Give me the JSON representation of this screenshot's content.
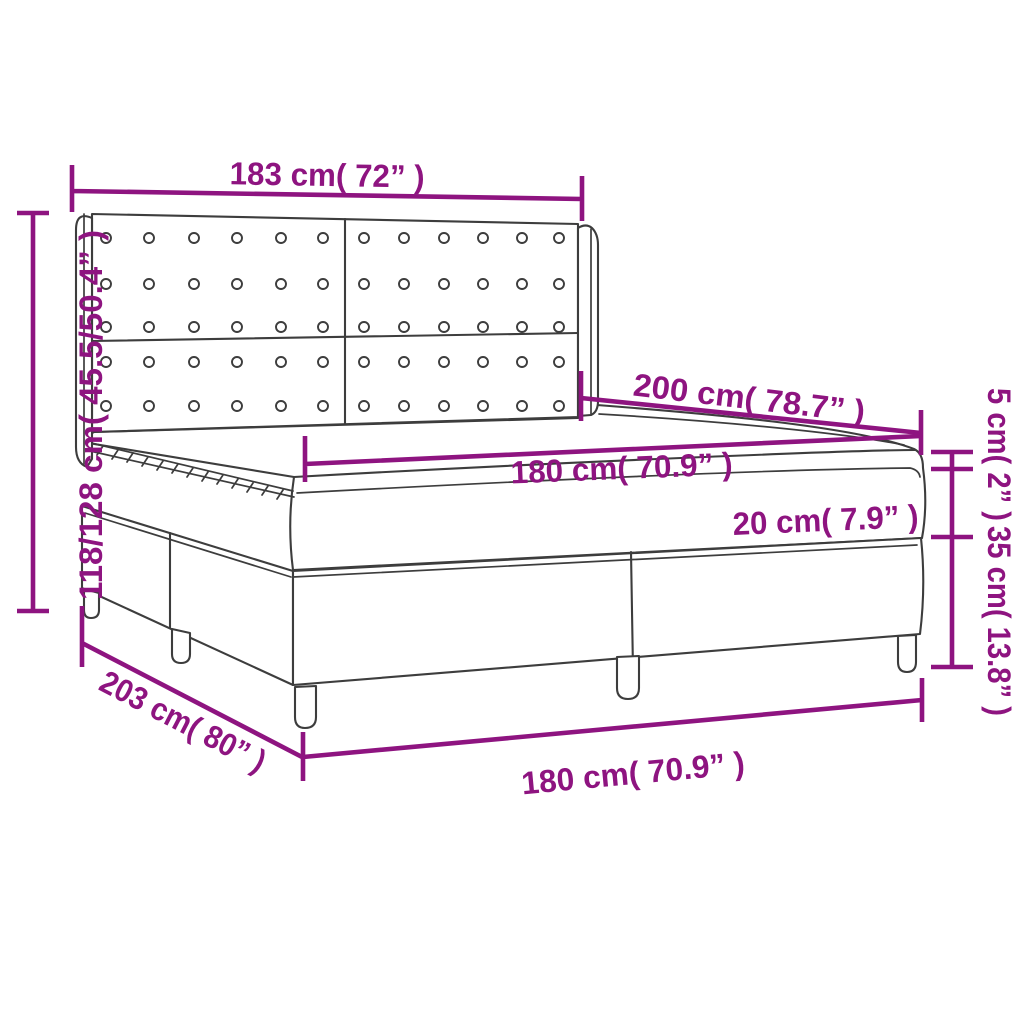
{
  "diagram": {
    "labels": {
      "headboard_width": "183 cm( 72” )",
      "headboard_height": "118/128 cm( 45.5/50.4” )",
      "bed_length": "200 cm( 78.7” )",
      "mattress_width": "180 cm( 70.9” )",
      "mattress_thickness": "20 cm( 7.9” )",
      "topper_thickness": "5 cm( 2” )",
      "base_height": "35 cm( 13.8” )",
      "base_length": "203 cm( 80” )",
      "base_width": "180 cm( 70.9” )"
    },
    "colors": {
      "dimension": "#8e1480",
      "outline": "#3d3d3d",
      "background": "#ffffff"
    }
  }
}
